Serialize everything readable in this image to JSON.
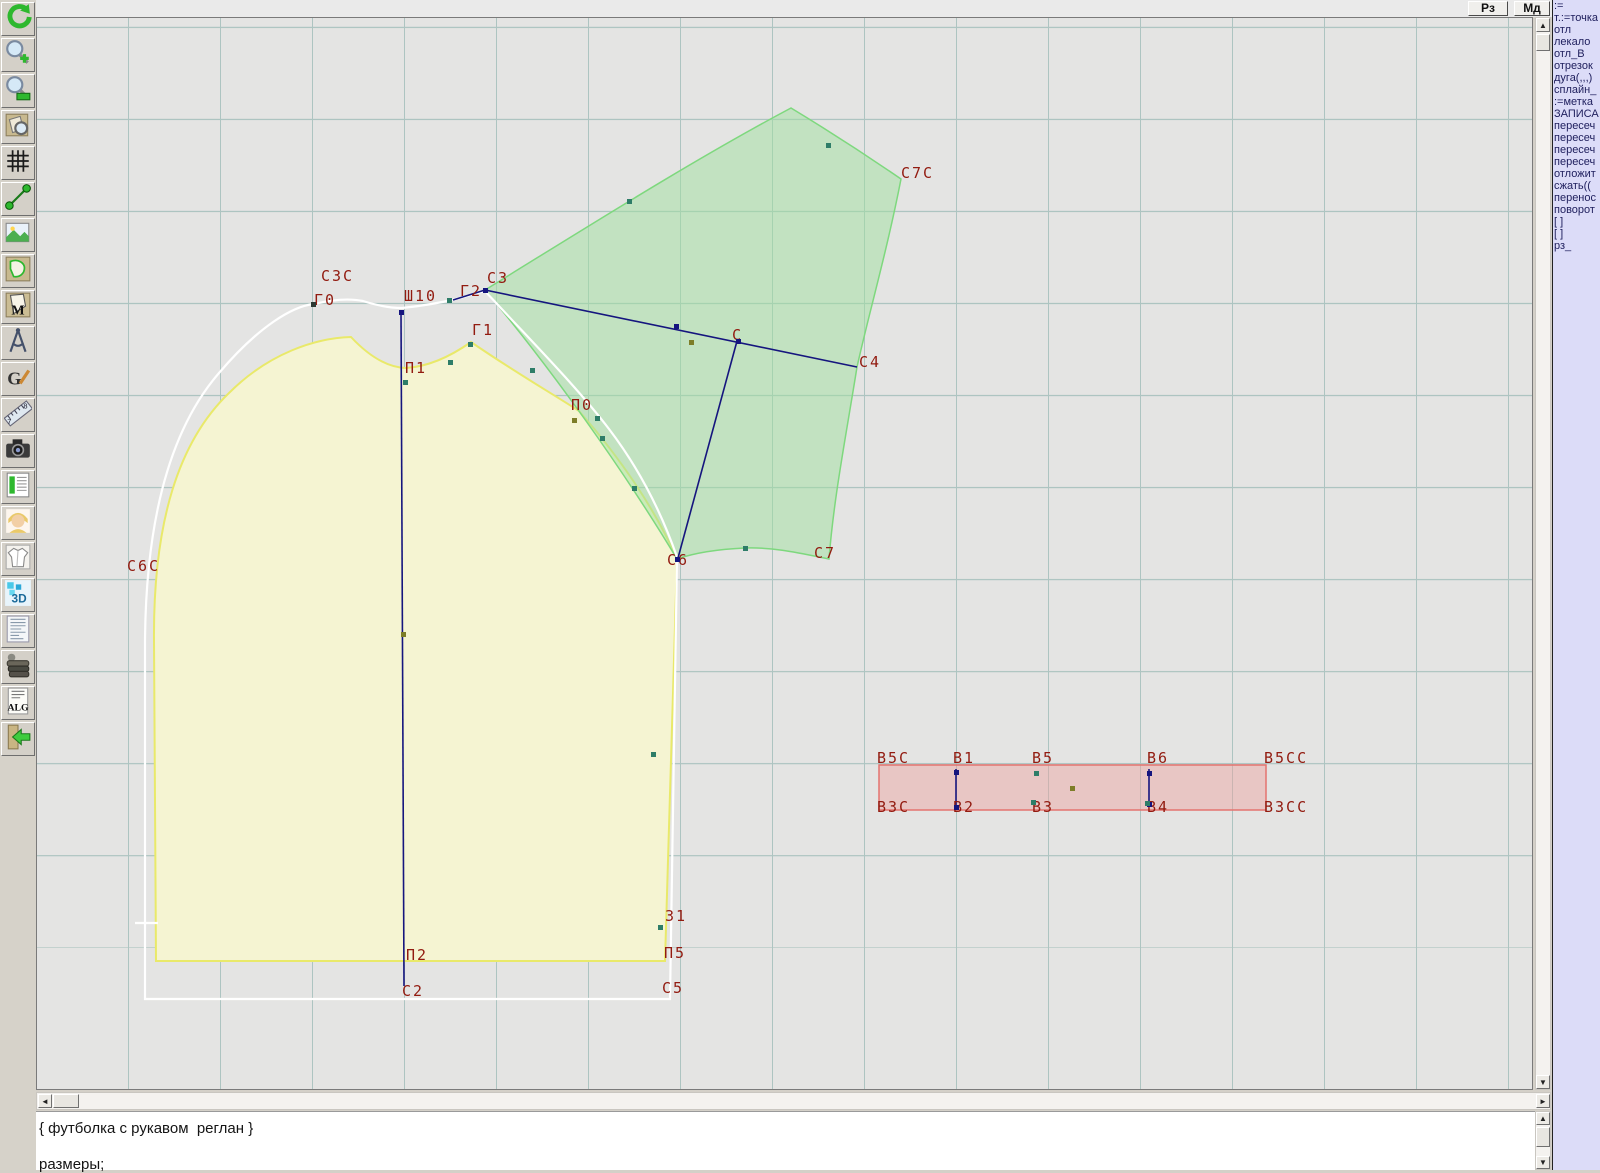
{
  "topbar": {
    "buttons": [
      {
        "name": "rz-button",
        "label": "Рз"
      },
      {
        "name": "md-button",
        "label": "Мд"
      }
    ]
  },
  "toolbar": {
    "icons": [
      {
        "name": "undo-icon"
      },
      {
        "name": "zoom-in-icon"
      },
      {
        "name": "zoom-tool-icon"
      },
      {
        "name": "piece-preview-icon"
      },
      {
        "name": "grid-icon"
      },
      {
        "name": "measure-segment-icon"
      },
      {
        "name": "image-icon"
      },
      {
        "name": "pattern-piece-icon"
      },
      {
        "name": "pattern-m-icon"
      },
      {
        "name": "compass-icon"
      },
      {
        "name": "g-tool-icon"
      },
      {
        "name": "ruler-icon"
      },
      {
        "name": "camera-icon"
      },
      {
        "name": "size-table-icon"
      },
      {
        "name": "portrait-icon"
      },
      {
        "name": "garment-sketch-icon"
      },
      {
        "name": "3d-icon"
      },
      {
        "name": "document-list-icon"
      },
      {
        "name": "books-icon"
      },
      {
        "name": "alg-icon"
      },
      {
        "name": "exit-icon"
      }
    ]
  },
  "right_panel": {
    "items": [
      ":=",
      "т.:=точка",
      "отл",
      "лекало",
      "отл_В",
      "отрезок",
      "дуга(,,,)",
      "сплайн_",
      ":=метка",
      "ЗАПИСА",
      "пересеч",
      "пересеч",
      "пересеч",
      "пересеч",
      "отложит",
      "сжать((",
      "перенос",
      "поворот",
      "[ ]",
      "[ ]",
      "рз_"
    ]
  },
  "scroll_glyphs": {
    "up": "▲",
    "down": "▼",
    "left": "◄",
    "right": "►"
  },
  "canvas": {
    "labels": [
      {
        "text": "С3С",
        "x": 320,
        "y": 266
      },
      {
        "text": "Г0",
        "x": 313,
        "y": 290
      },
      {
        "text": "Ш10",
        "x": 403,
        "y": 286
      },
      {
        "text": "Г2",
        "x": 459,
        "y": 281
      },
      {
        "text": "С3",
        "x": 486,
        "y": 268
      },
      {
        "text": "Г1",
        "x": 471,
        "y": 320
      },
      {
        "text": "П1",
        "x": 404,
        "y": 358
      },
      {
        "text": "П0",
        "x": 570,
        "y": 395
      },
      {
        "text": "С7С",
        "x": 900,
        "y": 163
      },
      {
        "text": "С",
        "x": 731,
        "y": 325
      },
      {
        "text": "С4",
        "x": 858,
        "y": 352
      },
      {
        "text": "С6С",
        "x": 126,
        "y": 556
      },
      {
        "text": "С6",
        "x": 666,
        "y": 550
      },
      {
        "text": "С7",
        "x": 813,
        "y": 543
      },
      {
        "text": "В5С",
        "x": 876,
        "y": 748
      },
      {
        "text": "В1",
        "x": 952,
        "y": 748
      },
      {
        "text": "В5",
        "x": 1031,
        "y": 748
      },
      {
        "text": "В6",
        "x": 1146,
        "y": 748
      },
      {
        "text": "В5СС",
        "x": 1263,
        "y": 748
      },
      {
        "text": "В3С",
        "x": 876,
        "y": 797
      },
      {
        "text": "В2",
        "x": 952,
        "y": 797
      },
      {
        "text": "В3",
        "x": 1031,
        "y": 797
      },
      {
        "text": "В4",
        "x": 1146,
        "y": 797
      },
      {
        "text": "В3СС",
        "x": 1263,
        "y": 797
      },
      {
        "text": "З1",
        "x": 664,
        "y": 906
      },
      {
        "text": "П2",
        "x": 405,
        "y": 945
      },
      {
        "text": "П5",
        "x": 663,
        "y": 943
      },
      {
        "text": "С2",
        "x": 401,
        "y": 981
      },
      {
        "text": "С5",
        "x": 661,
        "y": 978
      }
    ],
    "points": [
      {
        "x": 400,
        "y": 311,
        "c": "navy"
      },
      {
        "x": 484,
        "y": 289,
        "c": "navy"
      },
      {
        "x": 675,
        "y": 325,
        "c": "navy"
      },
      {
        "x": 737,
        "y": 340,
        "c": "navy"
      },
      {
        "x": 676,
        "y": 558,
        "c": "navy"
      },
      {
        "x": 955,
        "y": 771,
        "c": "navy"
      },
      {
        "x": 1148,
        "y": 772,
        "c": "navy"
      },
      {
        "x": 955,
        "y": 806,
        "c": "navy"
      },
      {
        "x": 1148,
        "y": 803,
        "c": "navy"
      },
      {
        "x": 312,
        "y": 303,
        "c": "dark"
      },
      {
        "x": 448,
        "y": 299,
        "c": "teal"
      },
      {
        "x": 404,
        "y": 381,
        "c": "teal"
      },
      {
        "x": 449,
        "y": 361,
        "c": "teal"
      },
      {
        "x": 469,
        "y": 343,
        "c": "teal"
      },
      {
        "x": 531,
        "y": 369,
        "c": "teal"
      },
      {
        "x": 596,
        "y": 417,
        "c": "teal"
      },
      {
        "x": 601,
        "y": 437,
        "c": "teal"
      },
      {
        "x": 633,
        "y": 487,
        "c": "teal"
      },
      {
        "x": 628,
        "y": 200,
        "c": "teal"
      },
      {
        "x": 827,
        "y": 144,
        "c": "teal"
      },
      {
        "x": 744,
        "y": 547,
        "c": "teal"
      },
      {
        "x": 652,
        "y": 753,
        "c": "teal"
      },
      {
        "x": 659,
        "y": 926,
        "c": "teal"
      },
      {
        "x": 1035,
        "y": 772,
        "c": "teal"
      },
      {
        "x": 1032,
        "y": 801,
        "c": "teal"
      },
      {
        "x": 1146,
        "y": 802,
        "c": "teal"
      },
      {
        "x": 573,
        "y": 419,
        "c": "olive"
      },
      {
        "x": 690,
        "y": 341,
        "c": "olive"
      },
      {
        "x": 402,
        "y": 633,
        "c": "olive"
      },
      {
        "x": 1071,
        "y": 787,
        "c": "olive"
      }
    ],
    "segments": [
      {
        "x1": 400,
        "y1": 311,
        "x2": 403,
        "y2": 985
      },
      {
        "x1": 484,
        "y1": 289,
        "x2": 856,
        "y2": 366
      },
      {
        "x1": 736,
        "y1": 340,
        "x2": 677,
        "y2": 557
      },
      {
        "x1": 452,
        "y1": 299,
        "x2": 484,
        "y2": 289
      },
      {
        "x1": 955,
        "y1": 768,
        "x2": 955,
        "y2": 808
      },
      {
        "x1": 1148,
        "y1": 768,
        "x2": 1148,
        "y2": 804
      }
    ],
    "pieces": {
      "yellow_front": "M155,960 L153,640 C152,520 178,440 228,392 C268,352 315,337 350,336 Q378,366 405,367 Q436,365 470,341 C515,372 552,393 578,410 C622,460 656,512 676,558 L664,960 Z",
      "green_sleeve": "M484,289 C580,230 690,160 790,107 C828,130 868,156 900,178 C886,250 868,312 856,366 C845,435 833,495 828,558 C798,552 772,546 744,547 C722,548 696,551 676,558 C622,468 546,362 484,289 Z",
      "white_back": "M144,998 L144,640 C145,510 172,425 218,372 C258,325 292,305 313,303 Q342,296 362,300 Q384,307 401,307 Q430,304 455,298 L484,290 C532,342 576,386 608,428 C640,470 662,516 676,556 L669,998 Z",
      "white_tick": "M134,922 L157,922"
    },
    "band": {
      "x": 878,
      "y": 764,
      "w": 387,
      "h": 45
    }
  },
  "colors": {
    "grid": "#adc4c1",
    "label_red": "#921b10",
    "navy_line": "#15157e",
    "green_stroke": "#7ed87e",
    "yellow_stroke": "#e9e96a",
    "band_stroke": "#e4736f",
    "panel_bg": "#dcdcf8"
  },
  "editor": {
    "lines": [
      "{ футболка с рукавом  реглан }",
      "размеры;"
    ]
  }
}
